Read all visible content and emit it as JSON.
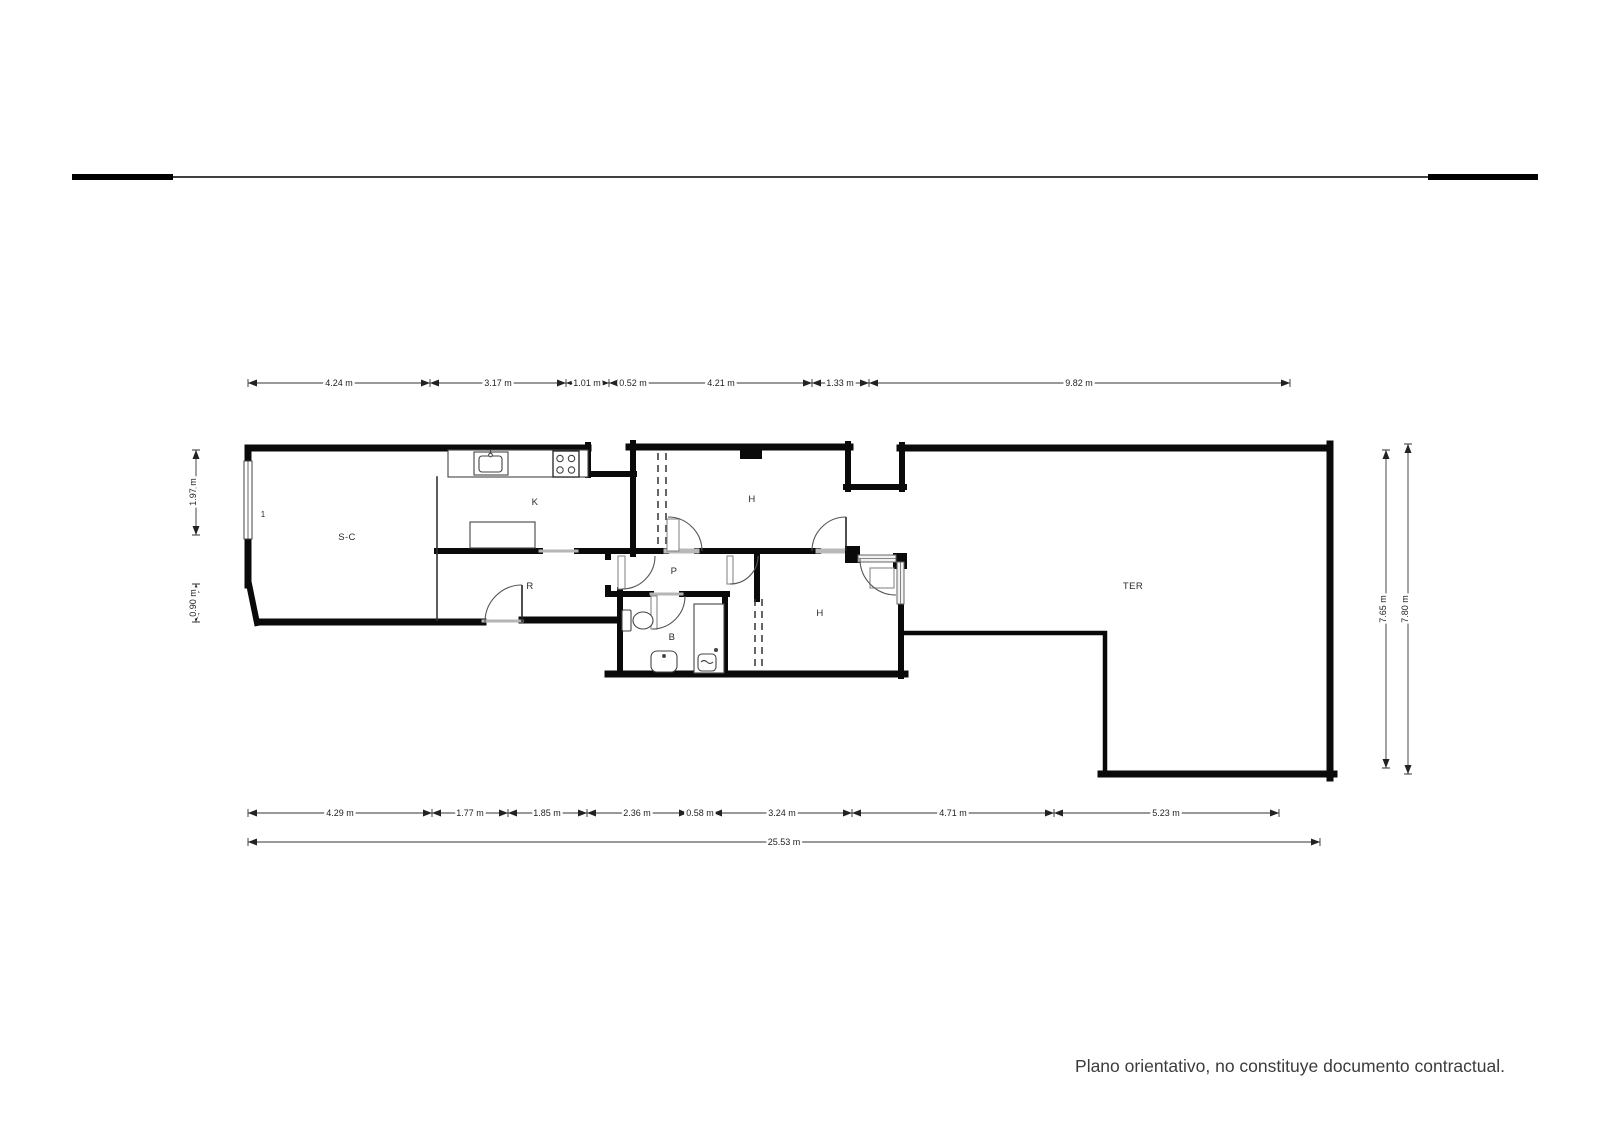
{
  "footer": {
    "disclaimer": "Plano orientativo, no constituye documento contractual."
  },
  "plan": {
    "rooms": [
      {
        "id": "living",
        "label": "S-C"
      },
      {
        "id": "kitchen",
        "label": "K"
      },
      {
        "id": "hall",
        "label": "R"
      },
      {
        "id": "corridor",
        "label": "P"
      },
      {
        "id": "bathroom",
        "label": "B"
      },
      {
        "id": "bedroom-1",
        "label": "H"
      },
      {
        "id": "bedroom-2",
        "label": "H"
      },
      {
        "id": "terrace",
        "label": "TER"
      }
    ],
    "window_tag": "1",
    "icons": [
      "sink-icon",
      "stove-icon",
      "toilet-icon",
      "shower-icon",
      "bidet-icon"
    ],
    "wall_color": "#0a0a0a",
    "dim_color": "#333333"
  },
  "dimensions": {
    "top": [
      "4.24 m",
      "3.17 m",
      "1.01 m",
      "0.52 m",
      "4.21 m",
      "1.33 m",
      "9.82 m"
    ],
    "bottom": [
      "4.29 m",
      "1.77 m",
      "1.85 m",
      "2.36 m",
      "0.58 m",
      "3.24 m",
      "4.71 m",
      "5.23 m"
    ],
    "total": "25.53 m",
    "left": [
      "1.97 m",
      "0.90 m"
    ],
    "right": [
      "7.65 m",
      "7.80 m"
    ]
  }
}
